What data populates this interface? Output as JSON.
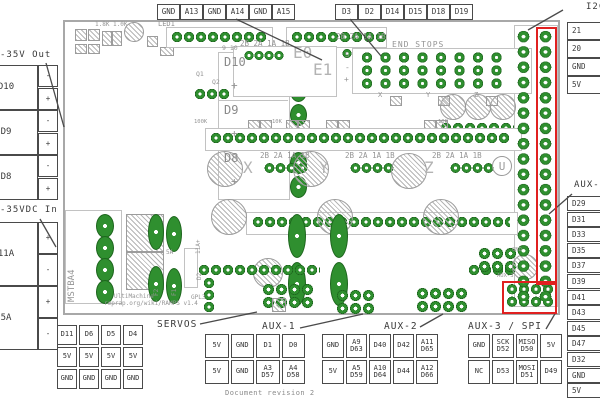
{
  "top": {
    "thermistor_pins": [
      "GND",
      "A13",
      "GND",
      "A14",
      "GND",
      "A15"
    ],
    "endstop_pins": [
      "D3",
      "D2",
      "D14",
      "D15",
      "D18",
      "D19"
    ]
  },
  "left": {
    "out_label": "-35V Out",
    "out_channels": [
      {
        "name": "D10",
        "top": "-",
        "bottom": "+"
      },
      {
        "name": "D9",
        "top": "-",
        "bottom": "+"
      },
      {
        "name": "D8",
        "top": "-",
        "bottom": "+"
      }
    ],
    "in_label": "-35VDC In",
    "in_channels": [
      {
        "name": "11A",
        "top": "+",
        "bottom": "-"
      },
      {
        "name": "5A",
        "top": "+",
        "bottom": "-"
      }
    ]
  },
  "right": {
    "i2c_label": "I2C",
    "i2c_pins": [
      "21",
      "20",
      "GND",
      "5V"
    ],
    "aux4_label": "AUX-4",
    "aux4_pins": [
      "D29",
      "D31",
      "D33",
      "D35",
      "D37",
      "D39",
      "D41",
      "D43",
      "D45",
      "D47",
      "D32",
      "GND",
      "5V"
    ]
  },
  "bottom": {
    "servos_label": "SERVOS",
    "servos_rows": [
      [
        "D11",
        "D6",
        "D5",
        "D4"
      ],
      [
        "5V",
        "5V",
        "5V",
        "5V"
      ],
      [
        "GND",
        "GND",
        "GND",
        "GND"
      ]
    ],
    "aux1_label": "AUX-1",
    "aux1_rows": [
      [
        "5V",
        "GND",
        "D1",
        "D0"
      ],
      [
        "5V",
        "GND",
        "A3 D57",
        "A4 D58"
      ]
    ],
    "aux2_label": "AUX-2",
    "aux2_rows": [
      [
        "GND",
        "A9 D63",
        "D40",
        "D42",
        "A11 D65"
      ],
      [
        "5V",
        "A5 D59",
        "A10 D64",
        "D44",
        "A12 D66"
      ]
    ],
    "aux3_label": "AUX-3 / SPI",
    "aux3_rows": [
      [
        "GND",
        "SCK D52",
        "MISO D50",
        "5V"
      ],
      [
        "NC",
        "D53",
        "MOSI D51",
        "D49"
      ]
    ],
    "revision": "Document revision 2"
  },
  "board": {
    "silkscreen": [
      "LED1",
      "1.8K 1.0K",
      "9 10",
      "D10",
      "+",
      "D9",
      "+",
      "D8",
      "+",
      "2B 2A 1A 1B",
      "E0",
      "E1",
      "2B 2A 1A 1B",
      "END STOPS",
      "S",
      "-",
      "+",
      "X",
      "Y",
      "Z",
      "100K",
      "10K",
      "10K",
      "2B 2A 1A 1B",
      "X",
      "2B 2A 1A 1B",
      "Y",
      "2B 2A 1A 1B",
      "Z",
      "U",
      "MSTBA4",
      "11A+",
      "5A",
      "F2",
      "F1",
      "D2",
      "Q1",
      "Q2",
      "GND",
      "AUX-3",
      "GPL3",
      "UltiMachine",
      "reprap.org/wiki/RAMPS v1.4"
    ]
  },
  "colors": {
    "pad_green": "#2f8f2f",
    "highlight_red": "#e02020"
  }
}
